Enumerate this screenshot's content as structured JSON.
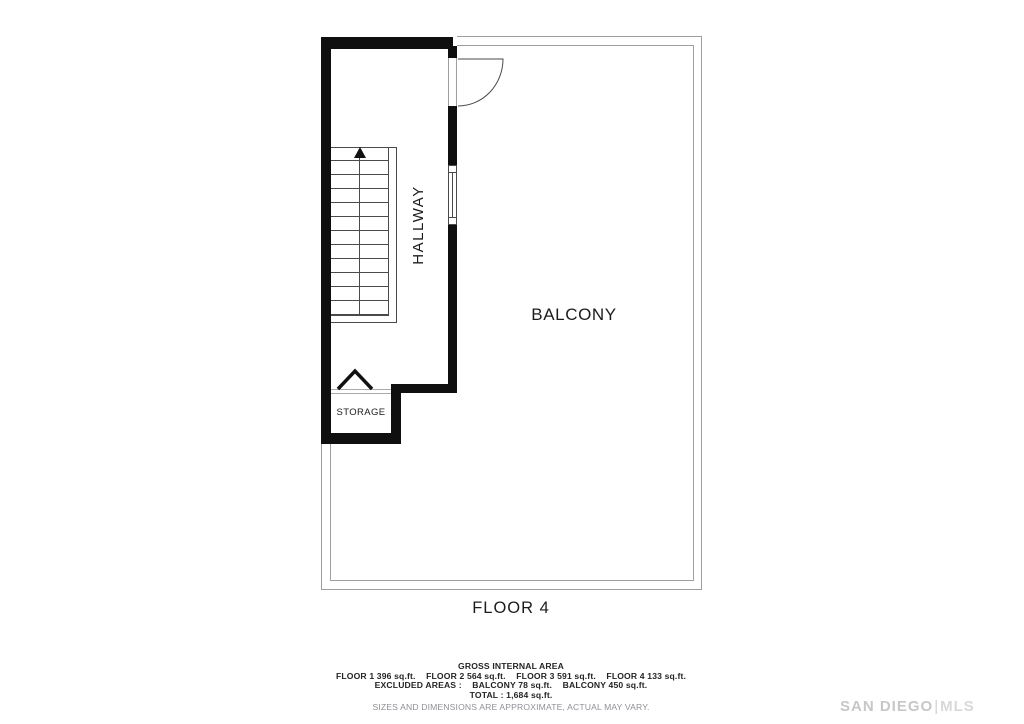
{
  "plan": {
    "floor_label": "FLOOR 4",
    "labels": {
      "hallway": "HALLWAY",
      "balcony": "BALCONY",
      "storage": "STORAGE"
    }
  },
  "footer": {
    "title": "GROSS INTERNAL AREA",
    "floors": [
      {
        "label": "FLOOR 1",
        "area": "396 sq.ft."
      },
      {
        "label": "FLOOR 2",
        "area": "564 sq.ft."
      },
      {
        "label": "FLOOR 3",
        "area": "591 sq.ft."
      },
      {
        "label": "FLOOR 4",
        "area": "133 sq.ft."
      }
    ],
    "excluded_label": "EXCLUDED AREAS :",
    "excluded": [
      {
        "label": "BALCONY",
        "area": "78 sq.ft."
      },
      {
        "label": "BALCONY",
        "area": "450 sq.ft."
      }
    ],
    "total_label": "TOTAL :",
    "total_value": "1,684 sq.ft.",
    "disclaimer": "SIZES AND DIMENSIONS ARE APPROXIMATE, ACTUAL MAY VARY."
  },
  "watermark": {
    "brand": "SAN DIEGO",
    "divider": "|",
    "suffix": "MLS"
  },
  "colors": {
    "wall": "#0f0f0f",
    "thin_line": "#9e9e9e",
    "detail_line": "#4a4a4a",
    "text": "#1c1c1c",
    "muted_text": "#8f9097",
    "watermark": "#c7c7c7"
  }
}
